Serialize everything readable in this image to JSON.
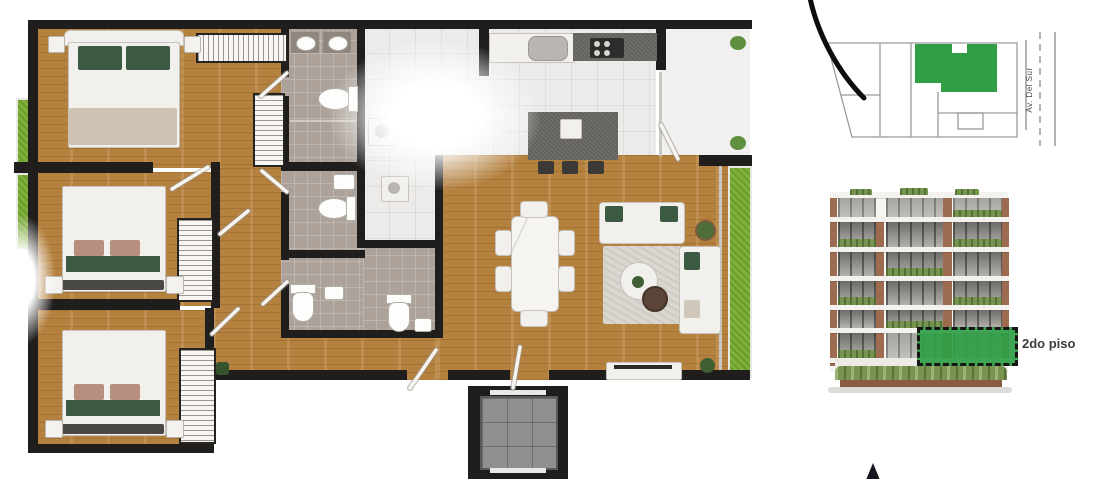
{
  "site_plan": {
    "street_label": "Av. Del Sur",
    "unit_color": "#2f9e44",
    "outline_color": "#9b9b9b"
  },
  "elevation": {
    "floor_label": "2do piso",
    "highlight_color": "#2f9e44"
  },
  "floor_plan": {
    "colors": {
      "wall": "#201e1c",
      "wood_floor": "#b5813f",
      "kitchen_tile": "#ecebe9",
      "bath_tile": "#aca29a",
      "grass": "#7fb03a",
      "counter_granite": "#63615d",
      "accent_pillow_green": "#3c5a42"
    }
  }
}
